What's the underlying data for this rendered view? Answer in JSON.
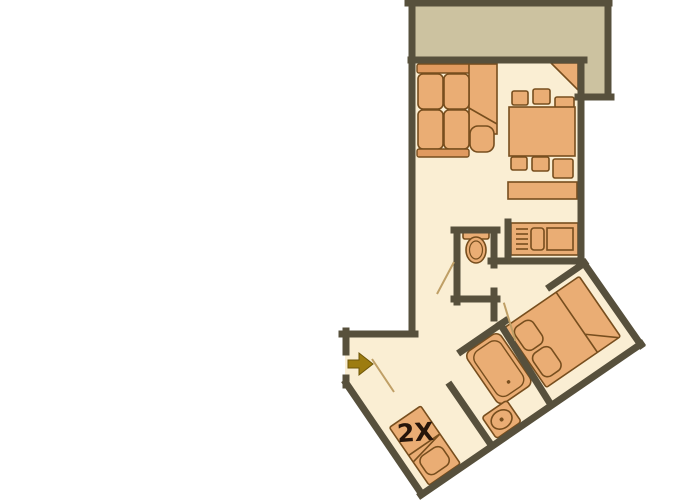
{
  "plan": {
    "bunk_bed_label": "2X",
    "entrance_marker": "arrow-pointing-right-into-apartment",
    "rooms": [
      "balcony",
      "living-dining-room",
      "kitchenette",
      "wc",
      "hallway",
      "bathroom",
      "bedroom"
    ],
    "furniture": [
      "corner-sofa",
      "ottoman",
      "dining-table",
      "six-chairs",
      "sideboard",
      "corner-cabinet",
      "kitchen-unit-with-hob-and-sink",
      "toilet",
      "bunk-bed-2x",
      "bathtub",
      "washbasin",
      "double-bed-with-two-pillows"
    ],
    "colors": {
      "background": "#ffffff",
      "floor": "#faeed3",
      "balcony_floor": "#ccc2a0",
      "walls": "#57503c",
      "furniture_fill": "#eaad74",
      "furniture_accent": "#e09a5f",
      "furniture_outline": "#774e1e",
      "entrance_arrow": "#9d7c10",
      "label_text": "#26150a"
    }
  }
}
